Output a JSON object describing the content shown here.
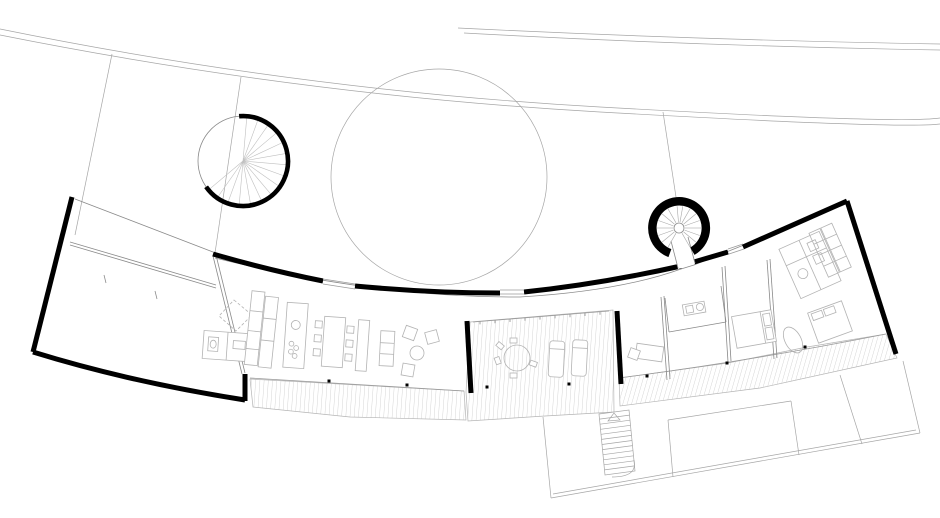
{
  "canvas": {
    "width": 940,
    "height": 518,
    "background": "#ffffff"
  },
  "palette": {
    "background": "#ffffff",
    "wall_ink": "#000000",
    "partition": "#8a8a8a",
    "furniture": "#b3b3b3",
    "site_line": "#a6a6a6",
    "deck_hatch": "#cccccc",
    "column_dot": "#000000"
  },
  "features": [
    "site-boundary-lines",
    "tree-canopy-circle",
    "spiral-staircase-left",
    "spiral-staircase-right",
    "entry-corridor",
    "garage-wing",
    "kitchen",
    "dining-table",
    "living-room-sofa-set",
    "central-terrace-deck",
    "terrace-round-table",
    "sun-loungers",
    "bedroom-desk",
    "bathrooms",
    "beds",
    "wardrobe",
    "bathtub",
    "exterior-stairs",
    "lower-terrace"
  ]
}
